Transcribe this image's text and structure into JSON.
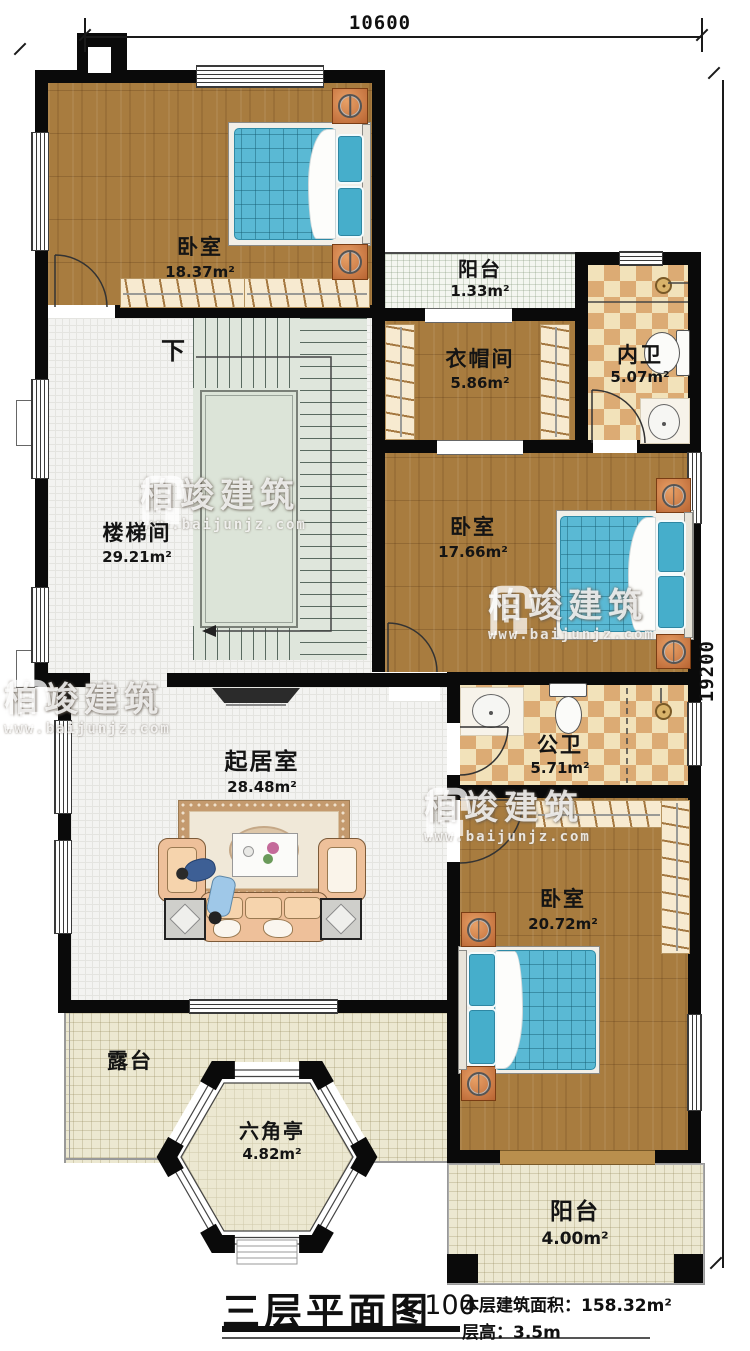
{
  "dimensions": {
    "top": "10600",
    "right": "19200"
  },
  "rooms": {
    "bedroom1": {
      "name": "卧室",
      "area": "18.37m²"
    },
    "balcony_top": {
      "name": "阳台",
      "area": "1.33m²"
    },
    "cloakroom": {
      "name": "衣帽间",
      "area": "5.86m²"
    },
    "bath_private": {
      "name": "内卫",
      "area": "5.07m²"
    },
    "stairwell": {
      "name": "楼梯间",
      "area": "29.21m²",
      "down_label": "下"
    },
    "bedroom2": {
      "name": "卧室",
      "area": "17.66m²"
    },
    "bath_public": {
      "name": "公卫",
      "area": "5.71m²"
    },
    "living_room": {
      "name": "起居室",
      "area": "28.48m²"
    },
    "bedroom3": {
      "name": "卧室",
      "area": "20.72m²"
    },
    "terrace": {
      "name": "露台"
    },
    "pavilion": {
      "name": "六角亭",
      "area": "4.82m²"
    },
    "balcony_bottom": {
      "name": "阳台",
      "area": "4.00m²"
    }
  },
  "title_block": {
    "title": "三层平面图",
    "scale": "1:100",
    "floor_area": "本层建筑面积：158.32m²",
    "floor_height": "层高：3.5m"
  },
  "watermark": {
    "brand": "柏竣建筑",
    "url": "www.baijunjz.com"
  },
  "colors": {
    "wall": "#0a0a0a",
    "wood_floor": "#a87c3f",
    "bed_mattress": "#5ab9d4",
    "bath_tile_warm": "#dcab74",
    "bath_tile_light": "#f2e2ba",
    "indoor_tile": "#f3f3f1",
    "terrace_tile": "#ece8d1",
    "stair_floor": "#dfe6dc",
    "nightstand_orange": "#cf7a3e",
    "sofa_peach": "#eec09a",
    "carpet_border": "#c49a6e"
  }
}
